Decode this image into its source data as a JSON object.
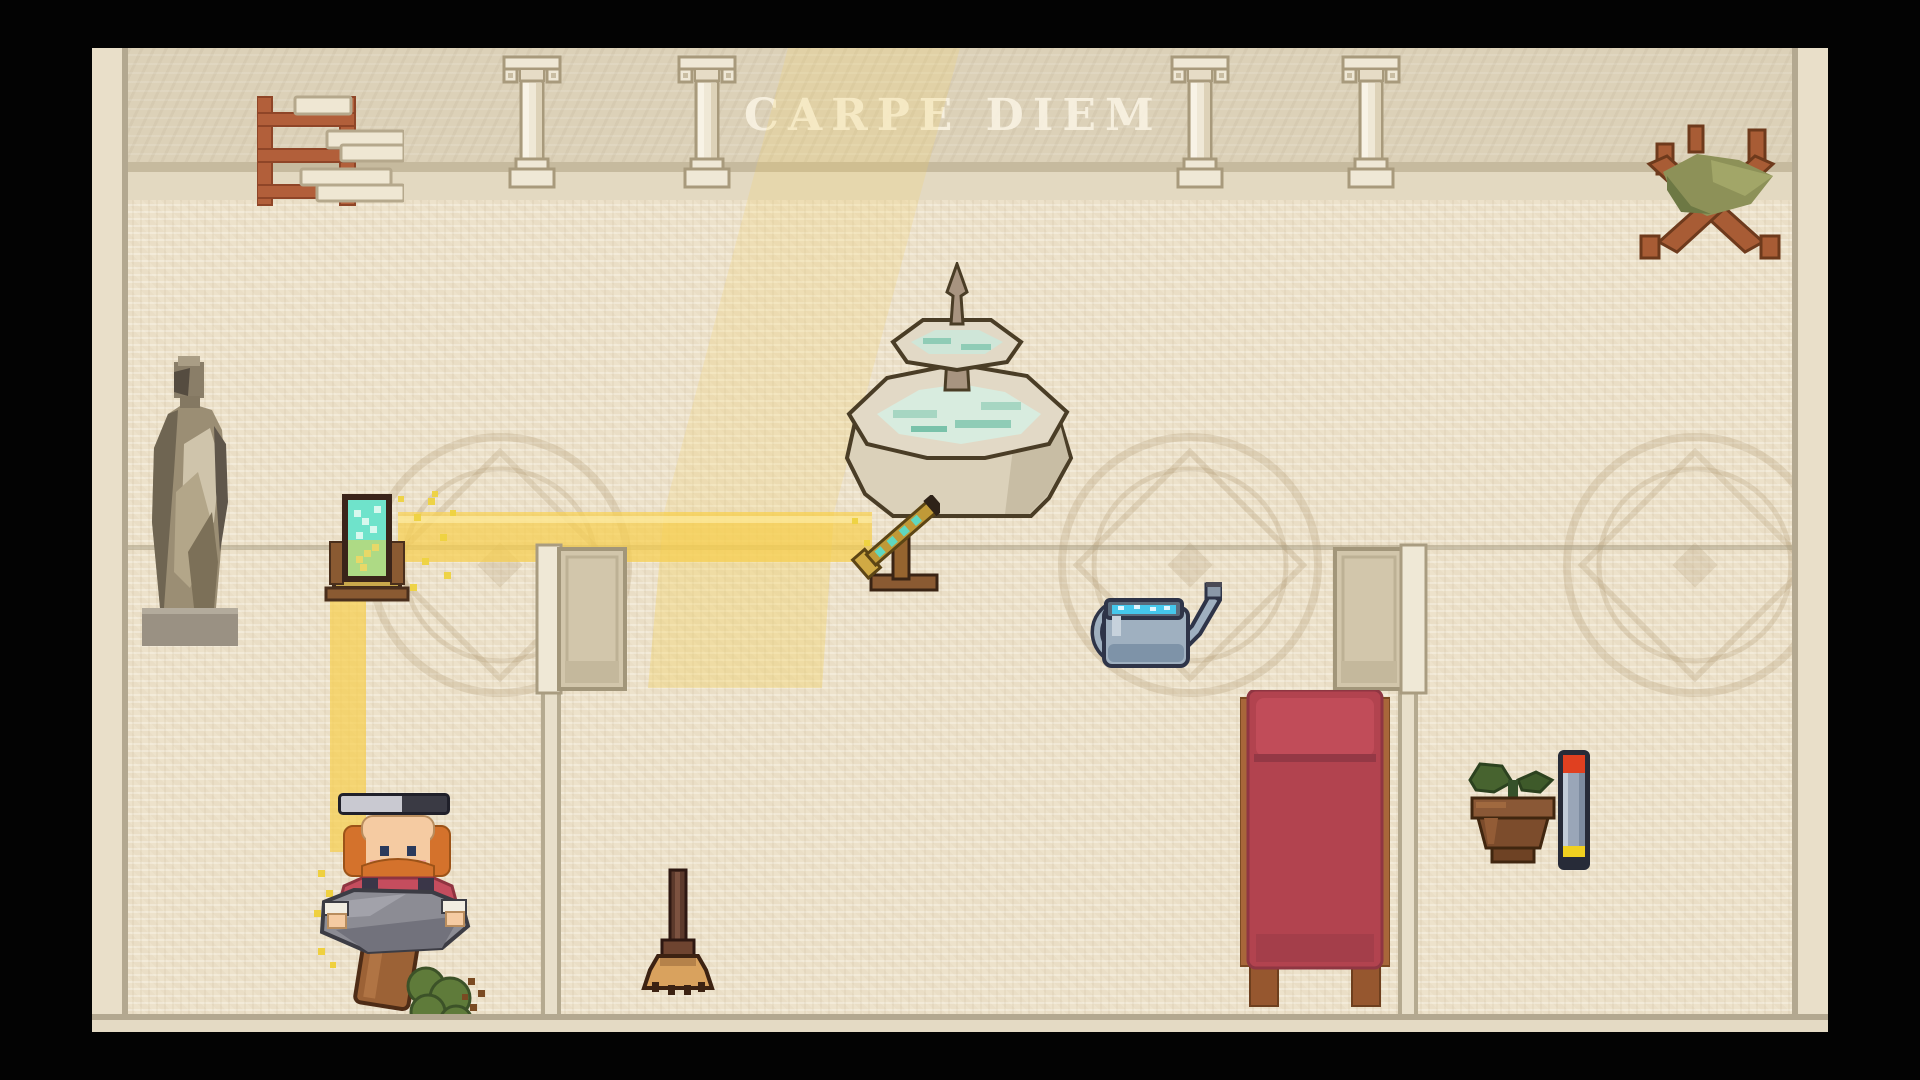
{
  "scene": {
    "inscription": "CARPE DIEM",
    "description": "Top-down pixel-art Roman atrium with sunbeam puzzle"
  },
  "indicators": {
    "character_progress": {
      "percent": 58
    },
    "wall_gauge": {
      "top_pct": 16,
      "bottom_pct": 10
    }
  },
  "entities": {
    "sprites": [
      "scroll-shelf",
      "ionic-column",
      "curule-bench",
      "toga-statue",
      "standing-mirror",
      "stone-fountain",
      "brass-telescope",
      "watering-can",
      "open-door-left",
      "open-door-right",
      "red-bed",
      "potted-seedling",
      "level-gauge",
      "gardener-character",
      "tipped-pot",
      "green-bush",
      "broom",
      "sunbeam",
      "sparkles",
      "floor-medallion"
    ]
  },
  "palette": {
    "floor": "#ede2cb",
    "wall": "#dcd1b8",
    "beam": "#f6cf4f",
    "wood": "#a85c35",
    "bedred": "#b2434f",
    "cushion": "#8d9158",
    "glass": "#6fe3cb",
    "stone": "#e2d9c6",
    "water": "#d8ecdf",
    "progressfill": "#c9c9d1",
    "progresstrack": "#3a3a44",
    "gaugetop": "#e04020",
    "gaugebody": "#9aa6b8",
    "gaugebottom": "#f0d020"
  }
}
